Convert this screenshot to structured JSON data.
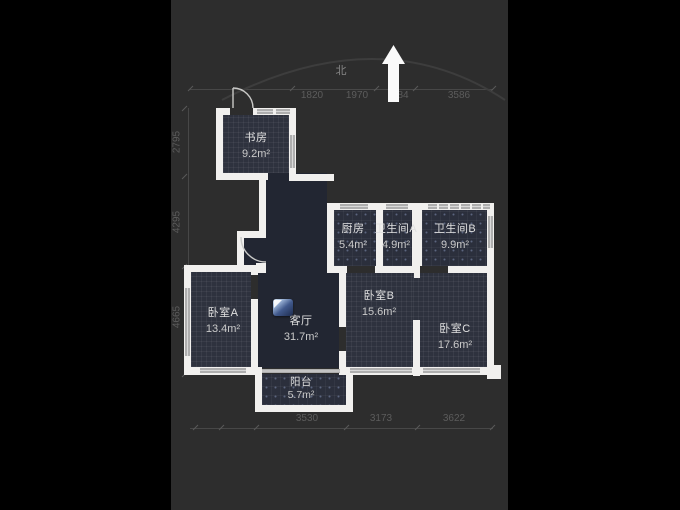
{
  "compass": {
    "north_label": "北"
  },
  "rooms": {
    "study": {
      "name": "书房",
      "area": "9.2m²"
    },
    "kitchen": {
      "name": "厨房",
      "area": "5.4m²"
    },
    "bathroom_a": {
      "name": "卫生间A",
      "area": "4.9m²"
    },
    "bathroom_b": {
      "name": "卫生间B",
      "area": "9.9m²"
    },
    "bedroom_a": {
      "name": "卧室A",
      "area": "13.4m²"
    },
    "living_room": {
      "name": "客厅",
      "area": "31.7m²"
    },
    "bedroom_b": {
      "name": "卧室B",
      "area": "15.6m²"
    },
    "bedroom_c": {
      "name": "卧室C",
      "area": "17.6m²"
    },
    "balcony": {
      "name": "阳台",
      "area": "5.7m²"
    }
  },
  "dimensions": {
    "top": [
      "1820",
      "1970",
      "84",
      "3586"
    ],
    "left": [
      "2795",
      "4295",
      "4665"
    ],
    "bottom": [
      "3530",
      "3173",
      "3622"
    ]
  },
  "colors": {
    "page_bg": "#000000",
    "canvas_bg": "#2d2d2d",
    "wall": "#f1f0ee",
    "room_fill": "#2e323e",
    "living_fill": "#222632",
    "window": "#aeaeae",
    "dimension_text": "#5c5c5c",
    "vr_icon_blue": "#41598c"
  }
}
